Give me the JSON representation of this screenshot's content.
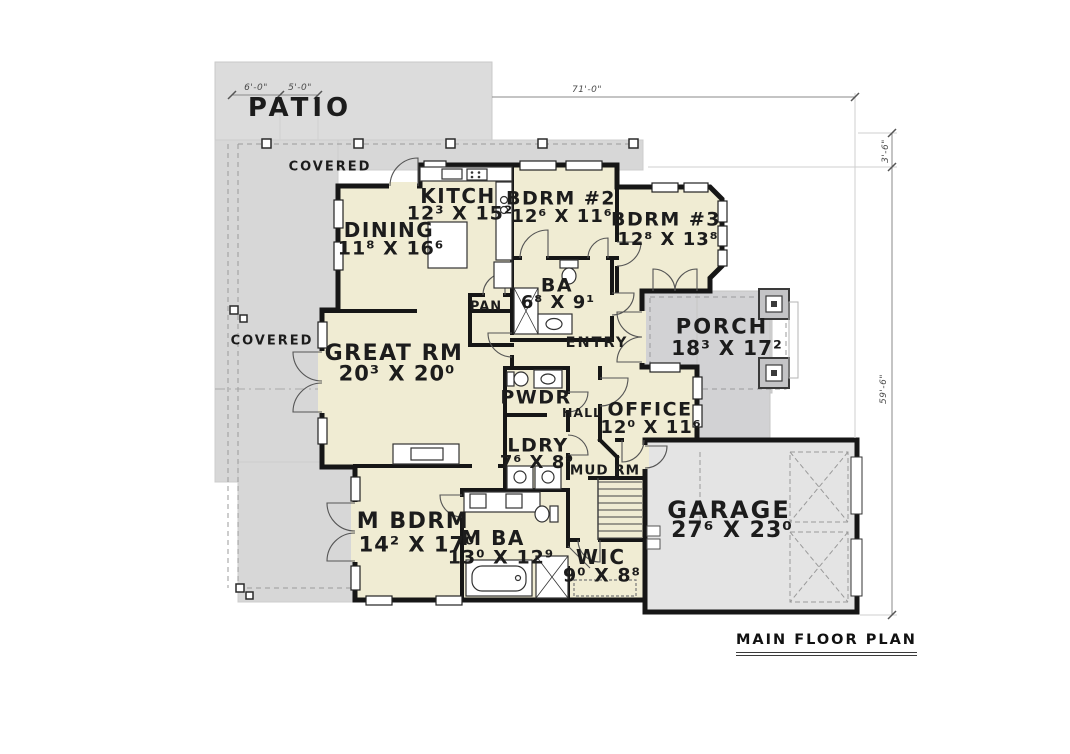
{
  "footer": {
    "title": "MAIN FLOOR PLAN"
  },
  "rooms": {
    "patio": {
      "label": "PATIO"
    },
    "covered_top": {
      "label": "COVERED"
    },
    "covered_left": {
      "label": "COVERED"
    },
    "kitchen": {
      "label": "KITCH",
      "dims": "12³ X 15²"
    },
    "dining": {
      "label": "DINING",
      "dims": "11⁸ X 16⁶"
    },
    "bdrm2": {
      "label": "BDRM #2",
      "dims": "12⁶ X 11⁶"
    },
    "bdrm3": {
      "label": "BDRM #3",
      "dims": "12⁸ X 13⁸"
    },
    "ba": {
      "label": "BA",
      "dims": "6⁸ X 9¹"
    },
    "pan": {
      "label": "PAN"
    },
    "porch": {
      "label": "PORCH",
      "dims": "18³ X 17²"
    },
    "entry": {
      "label": "ENTRY"
    },
    "great_rm": {
      "label": "GREAT RM",
      "dims": "20³ X 20⁰"
    },
    "pwdr": {
      "label": "PWDR"
    },
    "hall": {
      "label": "HALL"
    },
    "office": {
      "label": "OFFICE",
      "dims": "12⁰ X 11⁶"
    },
    "ldry": {
      "label": "LDRY",
      "dims": "7⁶ X 8⁹"
    },
    "mud": {
      "label": "MUD RM"
    },
    "m_bdrm": {
      "label": "M BDRM",
      "dims": "14² X 17⁰"
    },
    "m_ba": {
      "label": "M BA",
      "dims": "13⁰ X 12⁹"
    },
    "wic": {
      "label": "WIC",
      "dims": "9⁰ X 8⁸"
    },
    "garage": {
      "label": "GARAGE",
      "dims": "27⁶ X 23⁰"
    }
  },
  "dimensions": {
    "patio_depth": "6'-0\"",
    "patio_inner": "5'-0\"",
    "width_total": "71'-0\"",
    "right_offset": "3'-6\"",
    "height_main": "59'-6\""
  },
  "colors": {
    "room_fill": "#f0ecd3",
    "patio_gray": "#dcdcdc",
    "covered_gray": "#d7d7d7",
    "porch_gray": "#d2d2d4",
    "garage_gray": "#e4e4e4",
    "wall": "#161616"
  }
}
